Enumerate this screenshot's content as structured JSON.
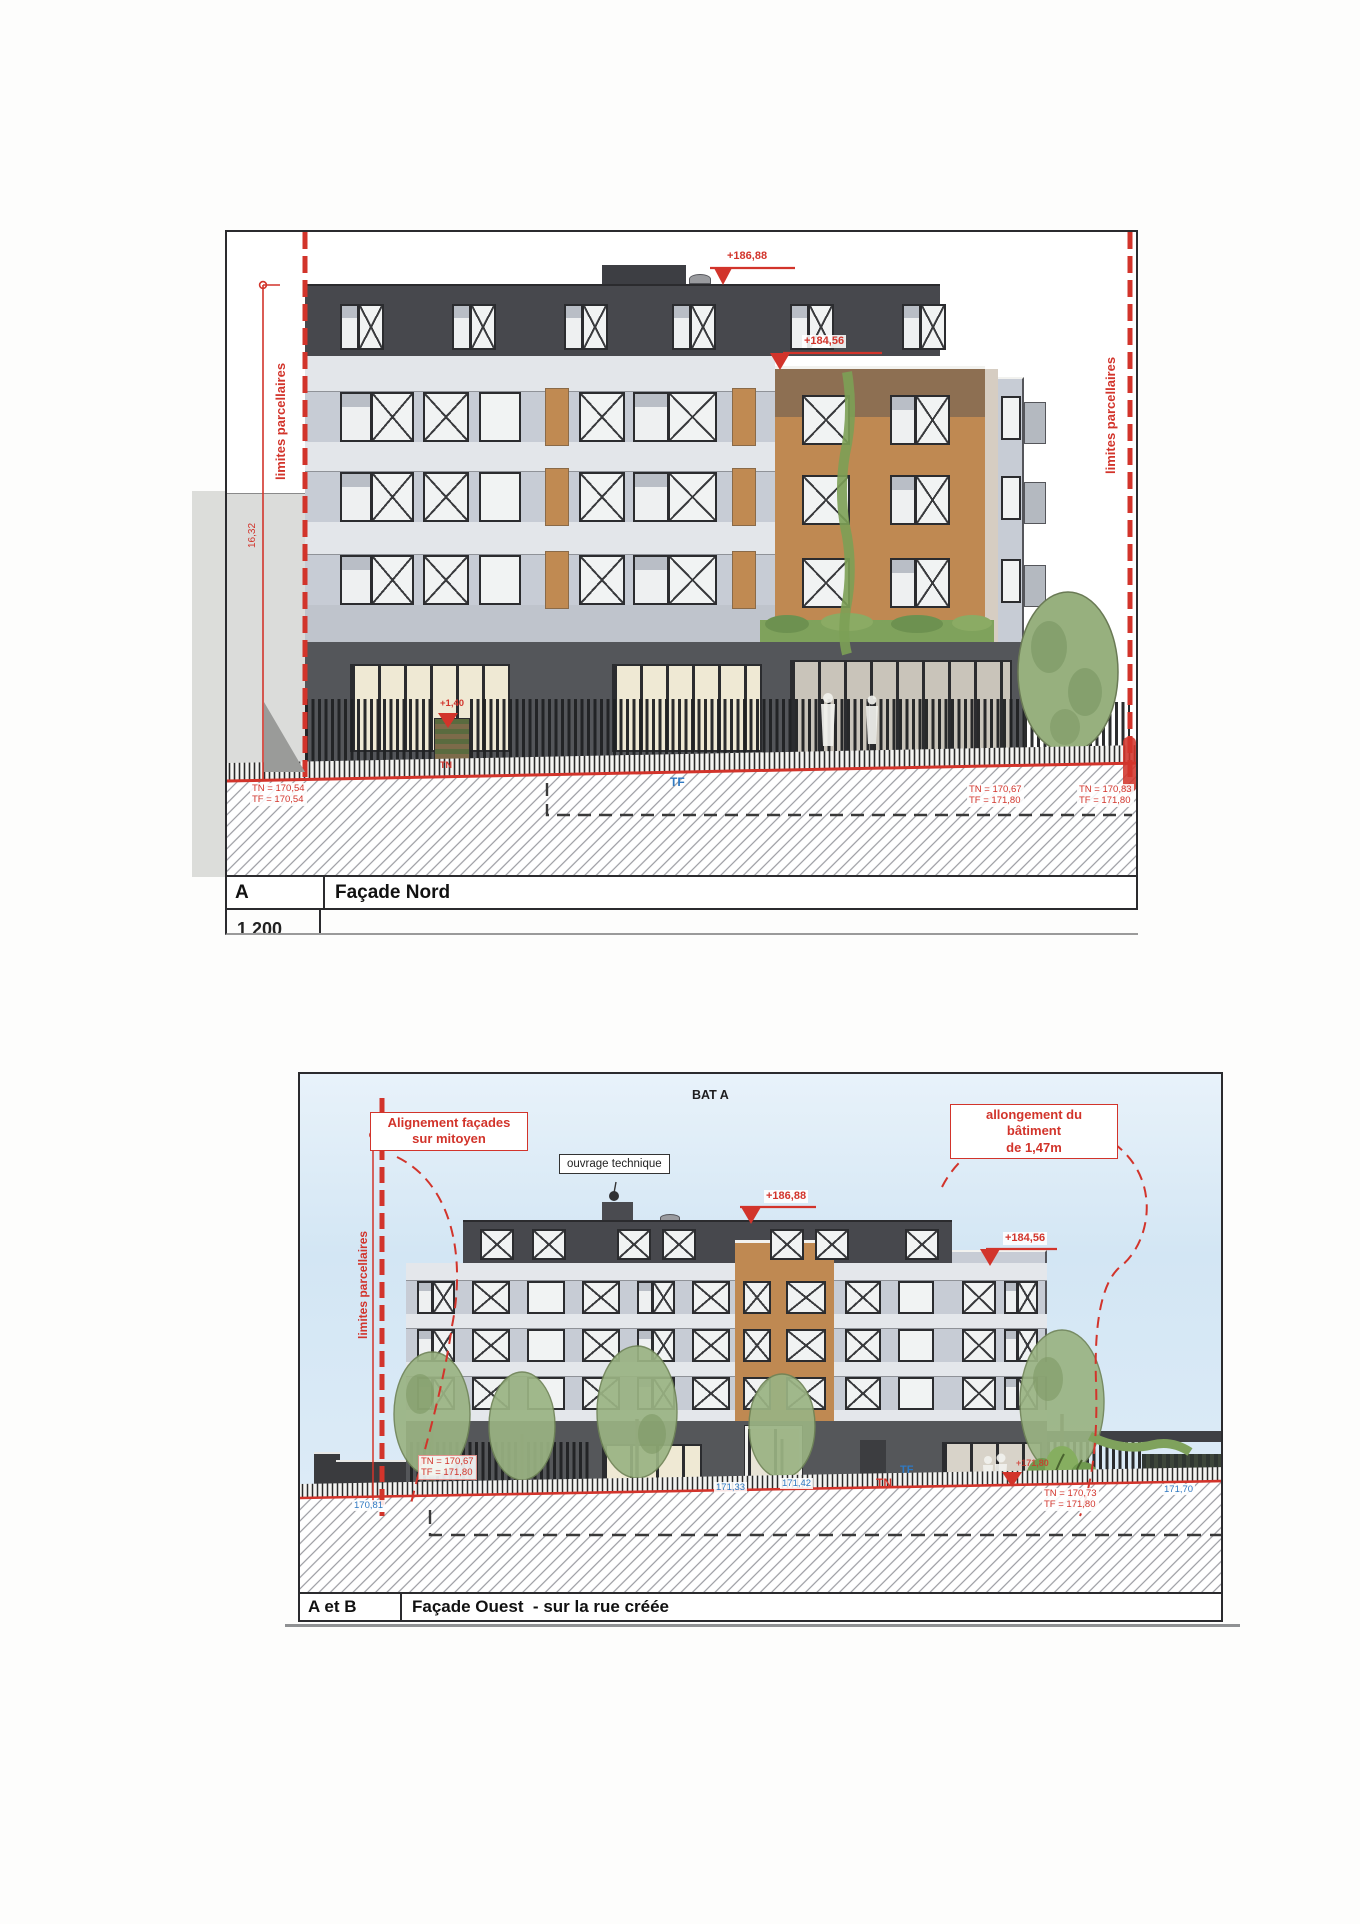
{
  "drawing1": {
    "key": "A",
    "title": "Façade Nord",
    "scale_partial": "1 200",
    "boundary_left": "limites parcellaires",
    "boundary_right": "limites parcellaires",
    "dim_height": "16,32",
    "marker_roof": "+186,88",
    "marker_wing": "+184,56",
    "marker_entry": "+1,40",
    "marker_entry_sub": "TN",
    "tn_left_1": "TN = 170,54",
    "tn_left_2": "TF = 170,54",
    "tf_center": "TF",
    "tn_mid_1": "TN = 170,67",
    "tn_mid_2": "TF = 171,80",
    "tn_right_1": "TN = 170,83",
    "tn_right_2": "TF = 171,80"
  },
  "drawing2": {
    "key": "A et B",
    "title": "Façade Ouest  - sur la rue créée",
    "bat": "BAT A",
    "callout_left_1": "Alignement façades",
    "callout_left_2": "sur mitoyen",
    "callout_right_1": "allongement du",
    "callout_right_2": "bâtiment",
    "callout_right_3": "de 1,47m",
    "ouvrage": "ouvrage technique",
    "boundary_left": "limites parcellaires",
    "marker_roof": "+186,88",
    "marker_wing": "+184,56",
    "marker_hidden": "+171,80",
    "box1_1": "TN = 170,67",
    "box1_2": "TF = 171,80",
    "road_left": "170,81",
    "road_c1": "171,33",
    "road_c2": "171,42",
    "tn_label": "TN",
    "tf_label": "TF",
    "box2_1": "TN = 170,73",
    "box2_2": "TF = 171,80",
    "road_right": "171,70"
  },
  "colors": {
    "annotation_red": "#d2342b",
    "annotation_blue": "#2f79c2",
    "facade_light": "#c7ccd5",
    "facade_dark": "#47484d",
    "brick": "#bf8952",
    "ground_dark": "#55575a"
  }
}
